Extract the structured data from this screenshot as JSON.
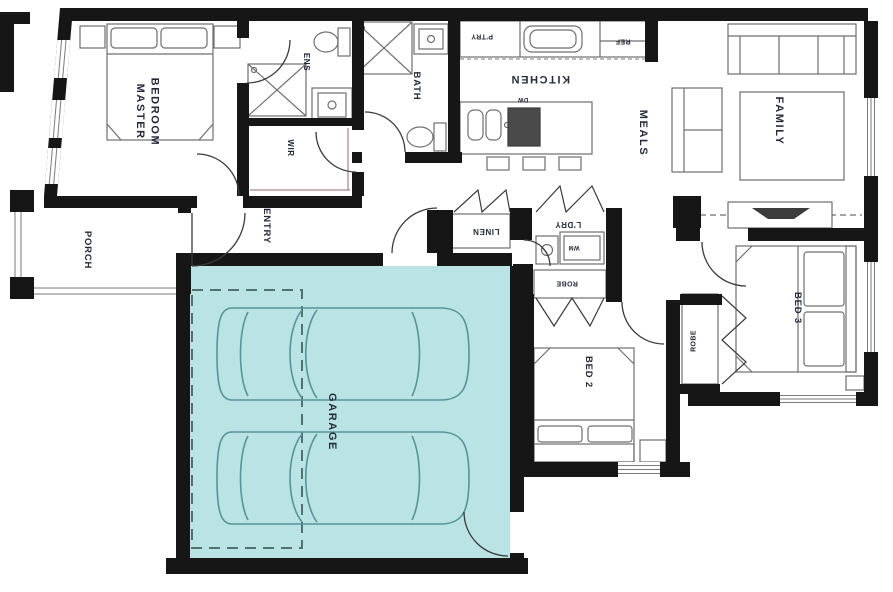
{
  "plan": {
    "rooms": {
      "master_bedroom": "MASTER\nBEDROOM",
      "ens": "ENS",
      "wir": "WIR",
      "bath": "BATH",
      "kitchen": "KITCHEN",
      "pantry": "P'TRY",
      "fridge": "REF",
      "dishwasher": "DW",
      "meals": "MEALS",
      "family": "FAMILY",
      "porch": "PORCH",
      "entry": "ENTRY",
      "linen": "LINEN",
      "laundry": "L'DRY",
      "laundry_note": "WM",
      "robe_bed2": "ROBE",
      "bed2": "BED 2",
      "robe_bed3": "ROBE",
      "bed3": "BED 3",
      "garage": "GARAGE"
    },
    "colors": {
      "garage_highlight": "#b9e3e4",
      "car_outline": "#57949a",
      "wall": "#161616"
    }
  }
}
